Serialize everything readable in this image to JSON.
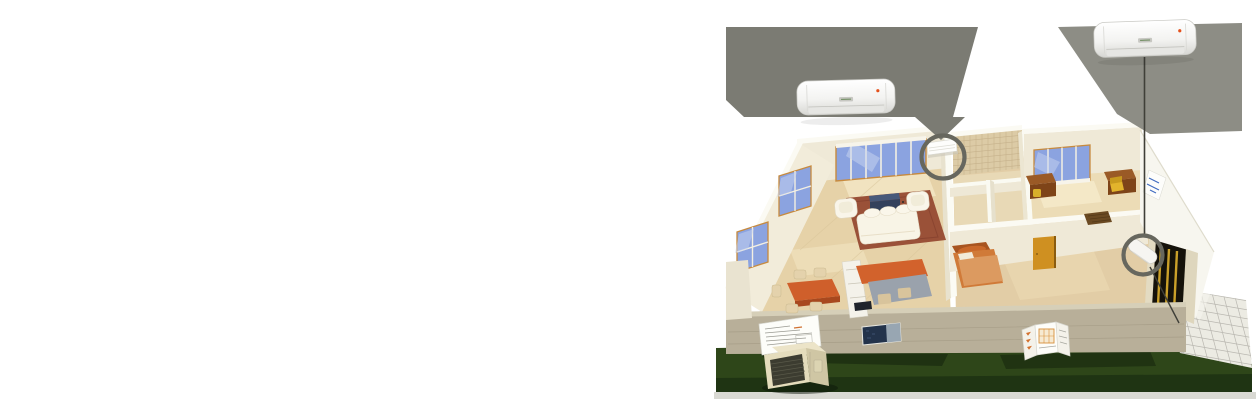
{
  "scene": {
    "description": "Isometric cutaway illustration of a one-storey home with two wall-mounted split air-conditioner indoor units shown enlarged above the house, gray callout beams and circles marking their installed positions, and an outdoor condenser unit on the lawn"
  },
  "products": {
    "indoor_unit_left": {
      "label": "wall-mounted indoor unit (living room)",
      "indicator_color": "#e4511c"
    },
    "indoor_unit_right": {
      "label": "wall-mounted indoor unit (patio side)",
      "indicator_color": "#e4511c"
    },
    "outdoor_unit": {
      "label": "outdoor condenser unit"
    },
    "installed_unit_living_room": {
      "label": "installed indoor unit on living-room wall"
    },
    "installed_unit_patio": {
      "label": "installed indoor unit on patio-side wall"
    }
  },
  "hotspots": {
    "living_room_ring": {
      "label": "callout circle - living room unit"
    },
    "patio_ring": {
      "label": "callout circle - patio-side unit"
    }
  },
  "palette": {
    "page_bg": "#ffffff",
    "beam_left": "#7b7b73",
    "beam_right": "#8d8d85",
    "ring_gray": "#67675e",
    "connector_line": "#3f3f38",
    "lawn_green": "#2e4619",
    "lawn_dark": "#1f3413",
    "wall_cream": "#efe9d7",
    "wall_top_white": "#fbfaf3",
    "floor_tan": "#e6d2a8",
    "front_wall_gray": "#b8af99",
    "window_glass": "#8ba3e0",
    "window_frame": "#c78a3e",
    "rug_terracotta": "#9a5138",
    "sofa_cream": "#f8f4e6",
    "counter_orange": "#d2622c",
    "table_orange": "#cf5f2b",
    "desk_brown": "#9a5a26",
    "door_amber": "#cf9021",
    "patio_tile": "#ecebe3",
    "unit_white": "#ffffff",
    "indicator_red": "#e4511c",
    "outdoor_unit_beige": "#e4dcbc",
    "grille_dark": "#3c3c30"
  }
}
